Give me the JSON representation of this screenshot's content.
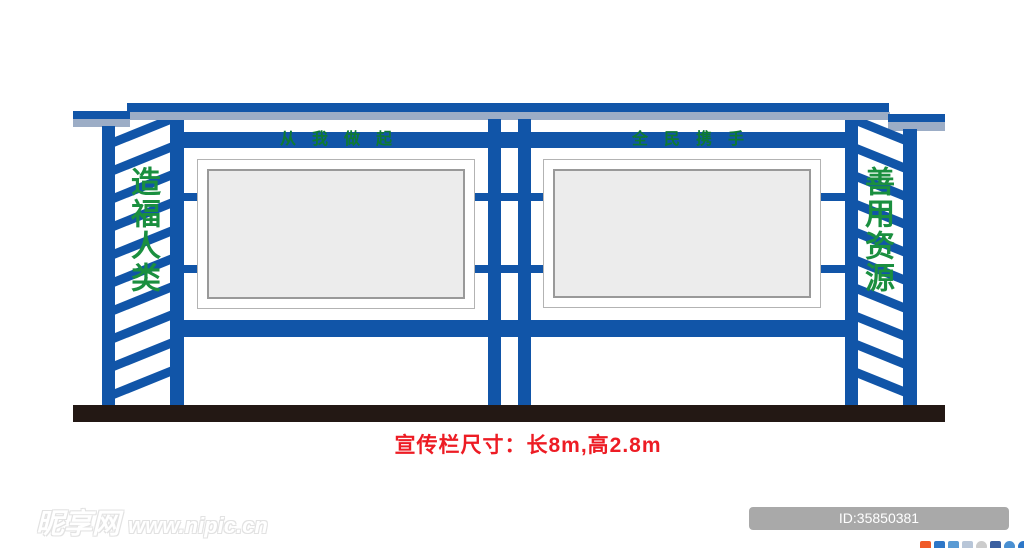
{
  "colors": {
    "blue": "#1155a8",
    "roof_gray": "#9cadc6",
    "green": "#1a8f3f",
    "header_green": "#0e7a32",
    "red": "#ed1c24",
    "base_black": "#231814",
    "panel_fill": "#ececec",
    "panel_border": "#999999",
    "badge_bg": "#a9a9a9"
  },
  "board": {
    "left_panel_header": "从我做起",
    "right_panel_header": "全民携手",
    "left_side_text": "造福人类",
    "right_side_text": "善用资源",
    "slat_count_left": 10,
    "slat_count_right": 10,
    "slat_spacing_px": 28
  },
  "caption": {
    "text": "宣传栏尺寸：长8m,高2.8m"
  },
  "watermark": {
    "site_name": "昵享网",
    "site_url": "www.nipic.cn"
  },
  "badge": {
    "text": "ID:35850381 NO:20250928161527952100"
  },
  "share_icons": [
    {
      "name": "share-icon-weibo",
      "color": "#f05a28",
      "round": false
    },
    {
      "name": "share-icon-qzone",
      "color": "#2d77c8",
      "round": false
    },
    {
      "name": "share-icon-renren",
      "color": "#5a9bd4",
      "round": false
    },
    {
      "name": "share-icon-kaixin",
      "color": "#b8c6d8",
      "round": false
    },
    {
      "name": "share-icon-douban",
      "color": "#cccccc",
      "round": true
    },
    {
      "name": "share-icon-tqq",
      "color": "#3b5fa0",
      "round": false
    },
    {
      "name": "share-icon-qq",
      "color": "#4a90d2",
      "round": true
    },
    {
      "name": "share-icon-more",
      "color": "#2d77c8",
      "round": true
    }
  ]
}
